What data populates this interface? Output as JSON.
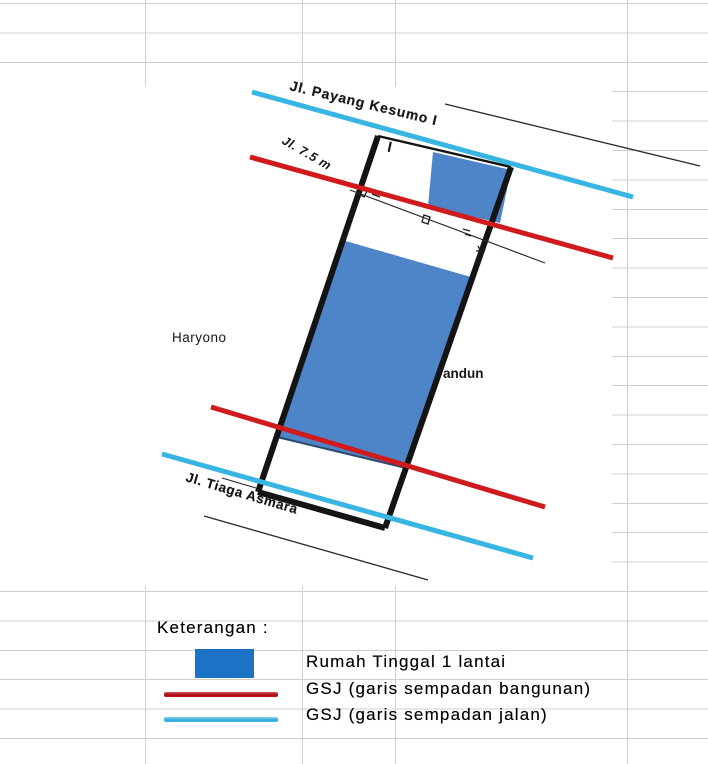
{
  "sheet": {
    "grid_color": "#cfcfcf"
  },
  "plan": {
    "street_top_label": "Jl. Payang Kesumo I",
    "street_bottom_label": "Jl. Tiaga Asmara",
    "dimension_label": "Jl. 7.5 m",
    "neighbor_left_label": "Haryono",
    "neighbor_right_label": "andun",
    "north_marker": "I",
    "colors": {
      "building_fill": "#4e84c8",
      "plot_boundary": "#141414",
      "gsb_red": "#d01b1e",
      "gsj_cyan": "#38b5e3"
    }
  },
  "legend": {
    "title": "Keterangan :",
    "items": [
      {
        "label": "Rumah Tinggal 1 lantai",
        "swatch": "blue-rect",
        "color": "#1c72c4"
      },
      {
        "label": "GSJ (garis sempadan bangunan)",
        "swatch": "red-line",
        "color": "#c31518"
      },
      {
        "label": "GSJ (garis sempadan jalan)",
        "swatch": "cyan-line",
        "color": "#3cb6e3"
      }
    ]
  }
}
